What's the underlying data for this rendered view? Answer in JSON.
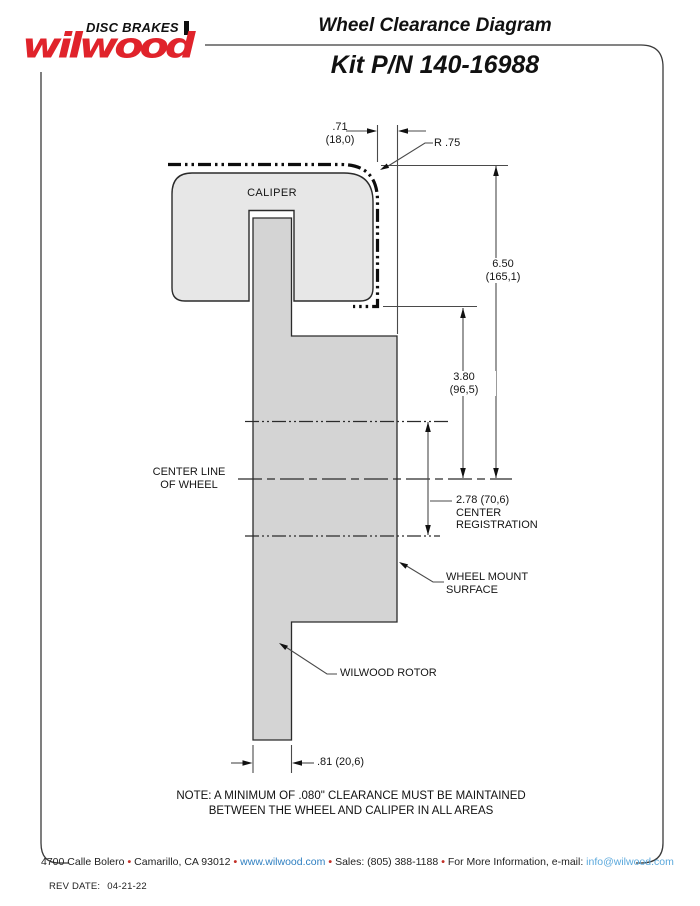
{
  "header": {
    "brand": {
      "tagline": "DISC BRAKES",
      "logo_text": "wilwood"
    },
    "title": "Wheel Clearance Diagram",
    "kit_number": "Kit P/N 140-16988"
  },
  "diagram": {
    "caliper_label": "CALIPER",
    "dimensions": {
      "caliper_offset": {
        "in": ".71",
        "mm": "(18,0)"
      },
      "corner_radius": "R .75",
      "overall_height": {
        "in": "6.50",
        "mm": "(165,1)"
      },
      "mount_to_envelope": {
        "in": "3.80",
        "mm": "(96,5)"
      },
      "center_registration": {
        "value": "2.78 (70,6)",
        "line2": "CENTER",
        "line3": "REGISTRATION"
      },
      "rotor_offset": ".81 (20,6)"
    },
    "labels": {
      "center_line": [
        "CENTER LINE",
        "OF WHEEL"
      ],
      "wheel_mount": [
        "WHEEL MOUNT",
        "SURFACE"
      ],
      "rotor": "WILWOOD ROTOR"
    }
  },
  "note": {
    "line1": "NOTE: A MINIMUM OF .080\" CLEARANCE MUST BE MAINTAINED",
    "line2": "BETWEEN THE WHEEL AND CALIPER IN ALL AREAS"
  },
  "footer": {
    "address": "4700 Calle Bolero",
    "city": "Camarillo, CA 93012",
    "url": "www.wilwood.com",
    "sales": "Sales: (805) 388-1188",
    "more_info": "For More Information, e-mail:",
    "email": "info@wilwood.com",
    "separator": "•"
  },
  "revision": {
    "label": "REV DATE:",
    "date": "04-21-22"
  },
  "colors": {
    "brand_red": "#e0232b",
    "link_blue": "#2e7fc1",
    "email_blue": "#5aa8dc",
    "bullet_red": "#c23128",
    "caliper_fill": "#e7e7e7",
    "rotor_fill": "#d4d4d4",
    "line_dark": "#2b2b2b"
  }
}
